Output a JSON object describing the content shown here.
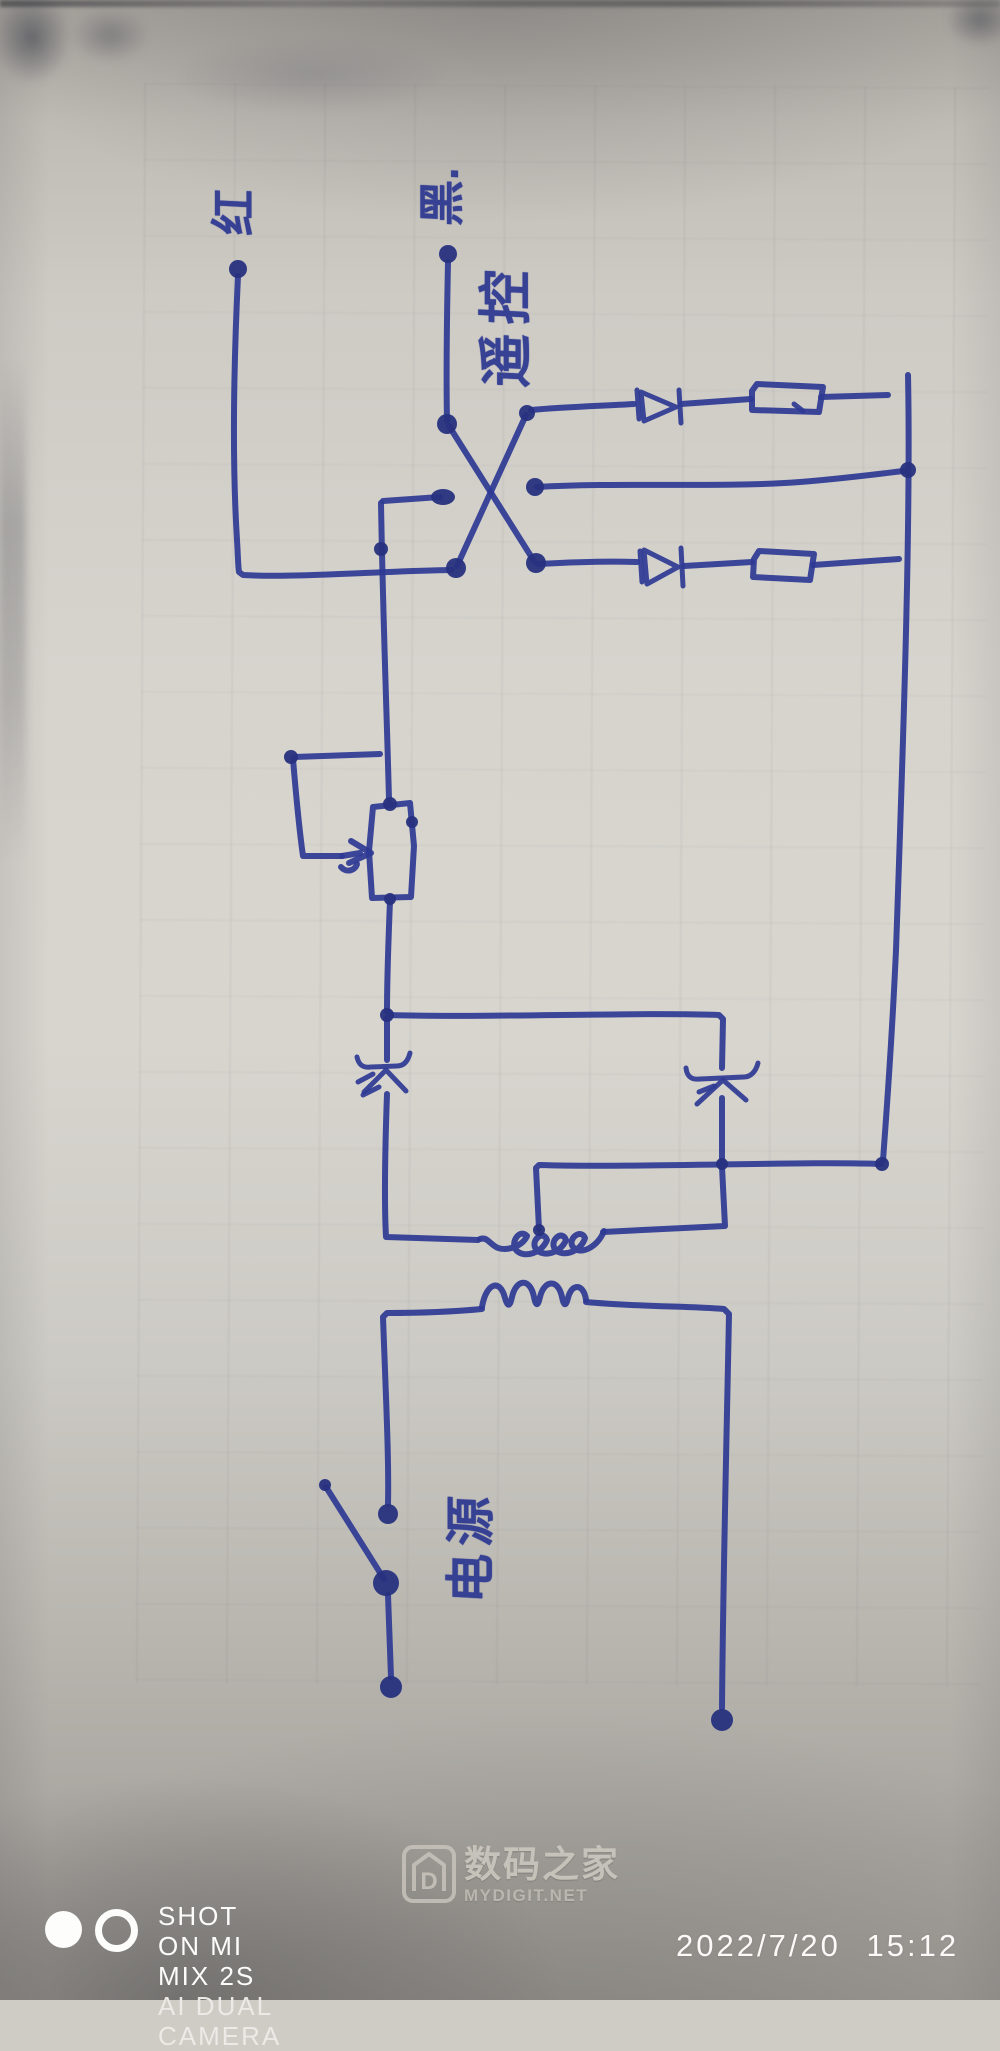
{
  "photo": {
    "description": "hand-drawn remote-control relay power circuit, blue pen on gray notebook paper",
    "ink_color": "#2e3a94",
    "paper_color": "#d2cfc9"
  },
  "handwritten_labels": {
    "output_red": "红",
    "output_black": "黑.",
    "remote_control": "遥控",
    "power_source": "电源"
  },
  "circuit": {
    "type": "schematic-sketch",
    "components": [
      {
        "name": "ac-power-input",
        "label": "电源",
        "terminals": 2,
        "switch": "open knife switch in left leg"
      },
      {
        "name": "transformer",
        "primary": "4 arch bumps",
        "secondary": "looped coil with tap wire"
      },
      {
        "name": "rectifier-diode-left",
        "orientation": "pointing up on left vertical"
      },
      {
        "name": "rectifier-diode-right",
        "orientation": "pointing up on right vertical"
      },
      {
        "name": "relay-coil-box",
        "symbol": "tall rectangle with actuating arrow from square loop"
      },
      {
        "name": "changeover-contacts",
        "symbol": "crossed X wires with stub contacts",
        "label": "遥控"
      },
      {
        "name": "output-branch-top",
        "parts": [
          "diode pointing right",
          "resistor box"
        ]
      },
      {
        "name": "output-branch-bottom",
        "parts": [
          "diode pointing right",
          "resistor box"
        ]
      },
      {
        "name": "output-terminal-red",
        "label": "红"
      },
      {
        "name": "output-terminal-black",
        "label": "黑."
      }
    ]
  },
  "watermark": {
    "site_name": "数码之家",
    "site_url": "MYDIGIT.NET",
    "logo_letter": "D"
  },
  "camera_overlay": {
    "line1": "SHOT ON MI MIX 2S",
    "line2": "AI DUAL CAMERA",
    "timestamp": "2022/7/20 15:12"
  }
}
